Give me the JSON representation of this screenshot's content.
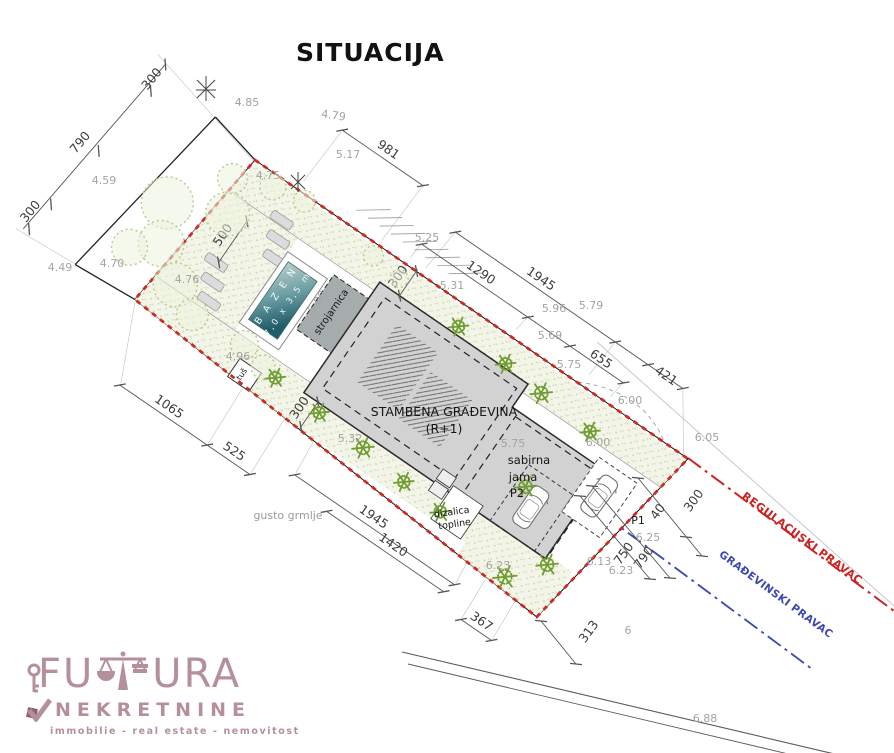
{
  "title": "SITUACIJA",
  "logo": {
    "word_start": "FU",
    "word_end": "URA",
    "line2": "NEKRETNINE",
    "tagline": "immobilie - real estate - nemovitost",
    "color": "#b4909c"
  },
  "colors": {
    "plot_boundary_red": "#cf2a20",
    "regulation_line_red": "#cc2222",
    "building_line_blue": "#3a47b0",
    "building_gray": "#d2d2d2",
    "strojarnica_gray": "#a6abab",
    "pool_dark": "#215d68",
    "pool_light": "#b9cdc9",
    "greenery": "#6f9d30",
    "tree_outline": "#b6c98c",
    "dim_text": "#3c3c3c",
    "elevation_text": "#a3a3a3"
  },
  "plan": {
    "angle_deg": 34.5,
    "anchor": {
      "x": 255,
      "y": 160
    },
    "labels": [
      [
        "981",
        104,
        -80,
        0,
        "L",
        "dim"
      ],
      [
        "1290",
        250,
        -31,
        0,
        "L",
        "dim"
      ],
      [
        "1945",
        303,
        -60,
        0,
        "L",
        "dim"
      ],
      [
        "655",
        398,
        -28,
        0,
        "L",
        "dim"
      ],
      [
        "421",
        461,
        -51,
        0,
        "L",
        "dim"
      ],
      [
        "300",
        -127,
        -8,
        -85,
        "L",
        "dim"
      ],
      [
        "790",
        -150,
        85,
        -85,
        "L",
        "dim"
      ],
      [
        "300",
        -152,
        170,
        -85,
        "L",
        "dim"
      ],
      [
        "500",
        20,
        80,
        -90,
        "L",
        "dim"
      ],
      [
        "300",
        188,
        15,
        -90,
        "L",
        "dim"
      ],
      [
        "300",
        181,
        179,
        -90,
        "L",
        "dim"
      ],
      [
        "1945",
        300,
        231,
        0,
        "L",
        "dim"
      ],
      [
        "1420",
        332,
        243,
        0,
        "L",
        "dim"
      ],
      [
        "1065",
        69,
        256,
        0,
        "L",
        "dim"
      ],
      [
        "525",
        148,
        256,
        0,
        "L",
        "dim"
      ],
      [
        "367",
        448,
        256,
        0,
        "L",
        "dim"
      ],
      [
        "40",
        661,
        514,
        -54,
        "G",
        "dim"
      ],
      [
        "300",
        697,
        503,
        -54,
        "G",
        "dim"
      ],
      [
        "750",
        627,
        556,
        -54,
        "G",
        "dim"
      ],
      [
        "790",
        647,
        560,
        -54,
        "G",
        "dim"
      ],
      [
        "313",
        592,
        634,
        -54,
        "G",
        "dim"
      ],
      [
        "4.85",
        247,
        106,
        0,
        "G",
        "elev"
      ],
      [
        "4.79",
        333,
        119,
        8,
        "G",
        "elev"
      ],
      [
        "5.17",
        348,
        158,
        0,
        "G",
        "elev"
      ],
      [
        "4.59",
        104,
        184,
        0,
        "G",
        "elev"
      ],
      [
        "4.75",
        268,
        179,
        0,
        "G",
        "elev"
      ],
      [
        "4.70",
        112,
        267,
        0,
        "G",
        "elev"
      ],
      [
        "4.49",
        60,
        271,
        0,
        "G",
        "elev"
      ],
      [
        "4.76",
        187,
        283,
        0,
        "G",
        "elev"
      ],
      [
        "5.00",
        320,
        304,
        -55,
        "G",
        "elev"
      ],
      [
        "4.96",
        238,
        360,
        0,
        "G",
        "elev"
      ],
      [
        "5.25",
        427,
        241,
        0,
        "G",
        "elev"
      ],
      [
        "5.31",
        452,
        289,
        0,
        "G",
        "elev"
      ],
      [
        "5.96",
        554,
        312,
        0,
        "G",
        "elev"
      ],
      [
        "5.79",
        591,
        309,
        0,
        "G",
        "elev"
      ],
      [
        "5.69",
        550,
        339,
        0,
        "G",
        "elev"
      ],
      [
        "5.75",
        569,
        368,
        0,
        "G",
        "elev"
      ],
      [
        "5.32",
        350,
        442,
        0,
        "G",
        "elev"
      ],
      [
        "5.75",
        513,
        447,
        0,
        "G",
        "elev"
      ],
      [
        "6.00",
        630,
        404,
        0,
        "G",
        "elev"
      ],
      [
        "6.00",
        598,
        446,
        0,
        "G",
        "elev"
      ],
      [
        "6.05",
        707,
        441,
        0,
        "G",
        "elev"
      ],
      [
        "6.25",
        648,
        541,
        0,
        "G",
        "elev"
      ],
      [
        "6.23",
        498,
        569,
        0,
        "G",
        "elev"
      ],
      [
        "6.13",
        599,
        565,
        0,
        "G",
        "elev"
      ],
      [
        "6.23",
        621,
        574,
        0,
        "G",
        "elev"
      ],
      [
        "6",
        628,
        634,
        0,
        "G",
        "elev"
      ],
      [
        "6.88",
        705,
        722,
        0,
        "G",
        "elev"
      ],
      [
        "STAMBENA GRAĐEVINA",
        444,
        416,
        0,
        "G",
        "name",
        12.5
      ],
      [
        "(R+1)",
        444,
        433,
        0,
        "G",
        "name",
        12.5
      ],
      [
        "sabirna",
        529,
        464,
        0,
        "G",
        "name"
      ],
      [
        "jama",
        523,
        481,
        0,
        "G",
        "name"
      ],
      [
        "P2",
        517,
        497,
        0,
        "G",
        "name"
      ],
      [
        "P1",
        638,
        524,
        0,
        "G",
        "name",
        11
      ],
      [
        "dizalica",
        452,
        515,
        -8,
        "G",
        "name",
        9.5
      ],
      [
        "topline",
        455,
        527,
        -8,
        "G",
        "name",
        9.5
      ],
      [
        "gusto grmlje",
        288,
        519,
        0,
        "G",
        "muted"
      ],
      [
        "REGULACIJSKI PRAVAC",
        800,
        541,
        36.5,
        "G",
        "red"
      ],
      [
        "GRAĐEVINSKI PRAVAC",
        774,
        597,
        36.5,
        "G",
        "blue"
      ],
      [
        "B A Z E N",
        97,
        100,
        -90,
        "L",
        "pool"
      ],
      [
        "7,0 x 3,5 m",
        111,
        100,
        -90,
        "L",
        "pool",
        8.5
      ],
      [
        "strojarnica",
        152,
        82,
        -90,
        "L",
        "name",
        10
      ],
      [
        "tuš",
        113,
        184,
        -90,
        "L",
        "name",
        8
      ]
    ],
    "dim_lines": [
      [
        "L",
        -128,
        -28,
        -152,
        188,
        [
          [
            -128,
            -28
          ],
          [
            -125,
            2
          ],
          [
            -134,
            81
          ],
          [
            -143,
            152
          ],
          [
            -147,
            185
          ]
        ]
      ],
      [
        "L",
        55,
        -74,
        153,
        -74,
        [
          [
            55,
            -74
          ],
          [
            153,
            -74
          ]
        ]
      ],
      [
        "L",
        206,
        -54,
        482,
        -54,
        [
          [
            206,
            -54
          ],
          [
            400,
            -54
          ],
          [
            440,
            -54
          ],
          [
            482,
            -54
          ]
        ]
      ],
      [
        "L",
        185,
        -25,
        430,
        -25,
        [
          [
            185,
            -25
          ],
          [
            314,
            -25
          ],
          [
            365,
            -25
          ],
          [
            430,
            -25
          ]
        ]
      ],
      [
        "L",
        28,
        55,
        28,
        105,
        [
          [
            28,
            55
          ],
          [
            28,
            105
          ]
        ]
      ],
      [
        "L",
        196,
        -2,
        196,
        32,
        [
          [
            196,
            0
          ],
          [
            196,
            30
          ]
        ]
      ],
      [
        "L",
        189,
        162,
        189,
        196,
        [
          [
            189,
            164
          ],
          [
            189,
            194
          ]
        ]
      ],
      [
        "L",
        211,
        237,
        405,
        237,
        [
          [
            211,
            237
          ],
          [
            405,
            237
          ]
        ]
      ],
      [
        "L",
        258,
        249,
        400,
        249,
        [
          [
            258,
            249
          ],
          [
            400,
            249
          ]
        ]
      ],
      [
        "L",
        16,
        262,
        174,
        262,
        [
          [
            16,
            262
          ],
          [
            122,
            262
          ],
          [
            174,
            262
          ]
        ]
      ],
      [
        "L",
        430,
        262,
        467,
        262,
        [
          [
            430,
            262
          ],
          [
            467,
            262
          ]
        ]
      ],
      [
        "G",
        638,
        478,
        702,
        556,
        [
          [
            638,
            478
          ],
          [
            686,
            537
          ],
          [
            702,
            556
          ]
        ]
      ],
      [
        "G",
        580,
        496,
        650,
        579,
        [
          [
            580,
            496
          ],
          [
            650,
            579
          ]
        ]
      ],
      [
        "G",
        592,
        486,
        670,
        578,
        [
          [
            592,
            486
          ],
          [
            670,
            578
          ]
        ]
      ],
      [
        "G",
        541,
        621,
        576,
        664,
        [
          [
            541,
            621
          ],
          [
            576,
            664
          ]
        ]
      ]
    ],
    "trees": [
      [
        -48,
        85,
        26
      ],
      [
        -30,
        122,
        23
      ],
      [
        -54,
        143,
        18
      ],
      [
        8,
        60,
        22
      ],
      [
        -8,
        28,
        15
      ],
      [
        30,
        12,
        13
      ],
      [
        64,
        6,
        11
      ],
      [
        5,
        148,
        22
      ],
      [
        36,
        163,
        16
      ],
      [
        96,
        158,
        14
      ],
      [
        124,
        166,
        12
      ],
      [
        152,
        12,
        10
      ],
      [
        186,
        16,
        9
      ]
    ],
    "bushes": [
      [
        262,
        22,
        10
      ],
      [
        322,
        26,
        10
      ],
      [
        368,
        30,
        11
      ],
      [
        430,
        34,
        10
      ],
      [
        140,
        168,
        10
      ],
      [
        196,
        172,
        10
      ],
      [
        252,
        176,
        11
      ],
      [
        305,
        181,
        10
      ],
      [
        352,
        185,
        10
      ],
      [
        408,
        116,
        11
      ],
      [
        470,
        168,
        11
      ],
      [
        442,
        202,
        12
      ]
    ]
  }
}
